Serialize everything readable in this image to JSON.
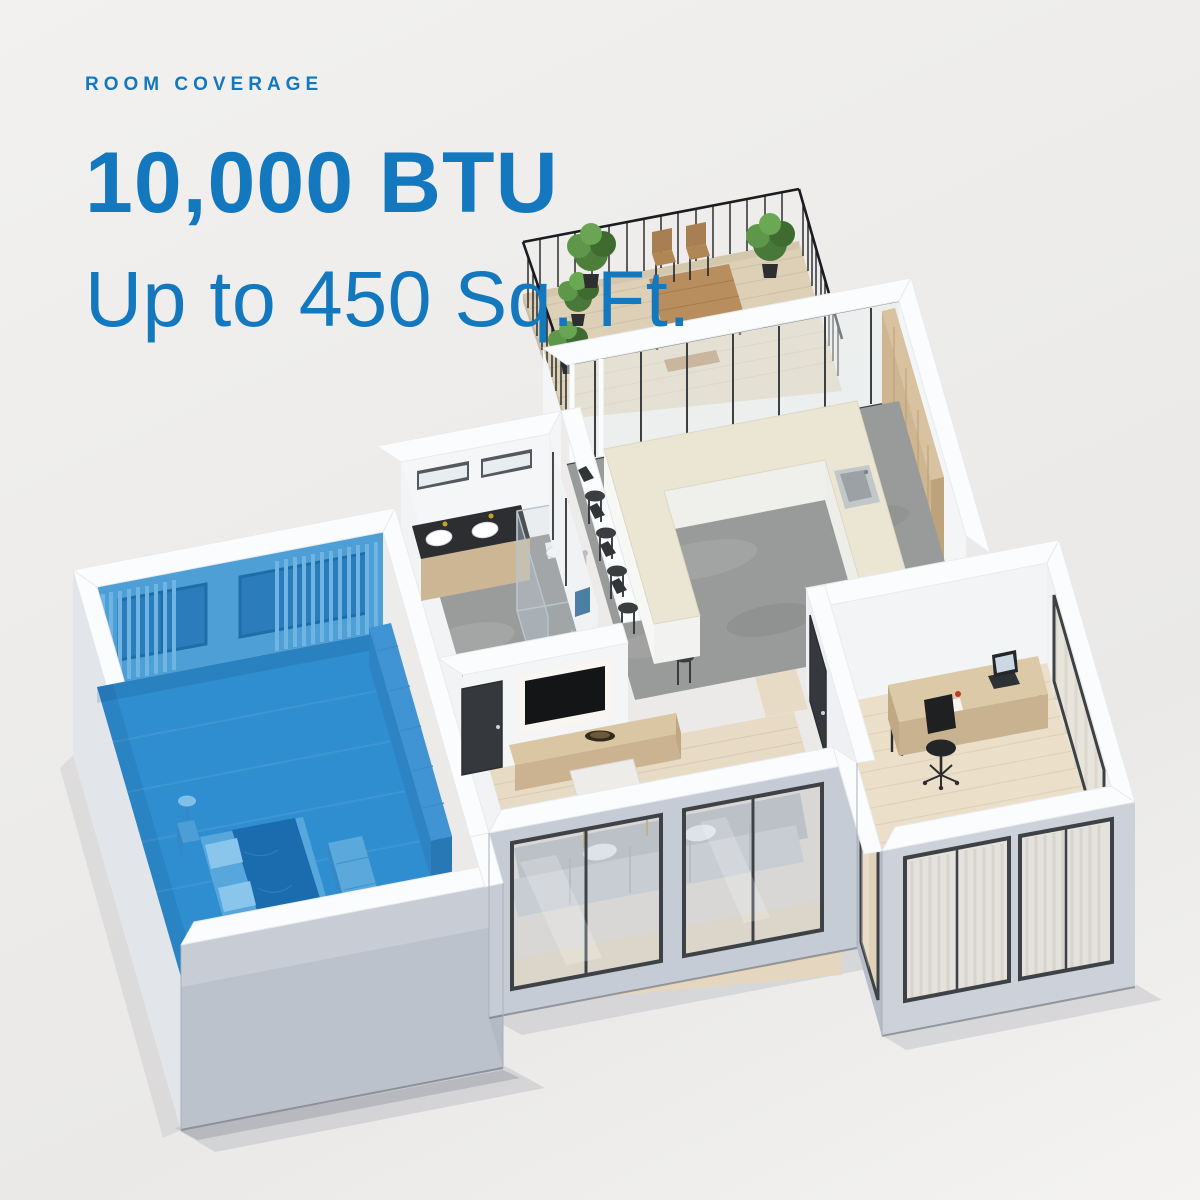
{
  "header": {
    "eyebrow": "ROOM COVERAGE",
    "headline": "10,000 BTU",
    "subheadline": "Up to 450 Sq. Ft."
  },
  "colors": {
    "accent": "#1478bf",
    "room-highlight": "#2f8ed0",
    "bg-top": "#f1f0ee",
    "bg-bottom": "#f4f3f1"
  },
  "illustration": {
    "type": "isometric-floor-plan",
    "highlighted_room": "bedroom"
  }
}
